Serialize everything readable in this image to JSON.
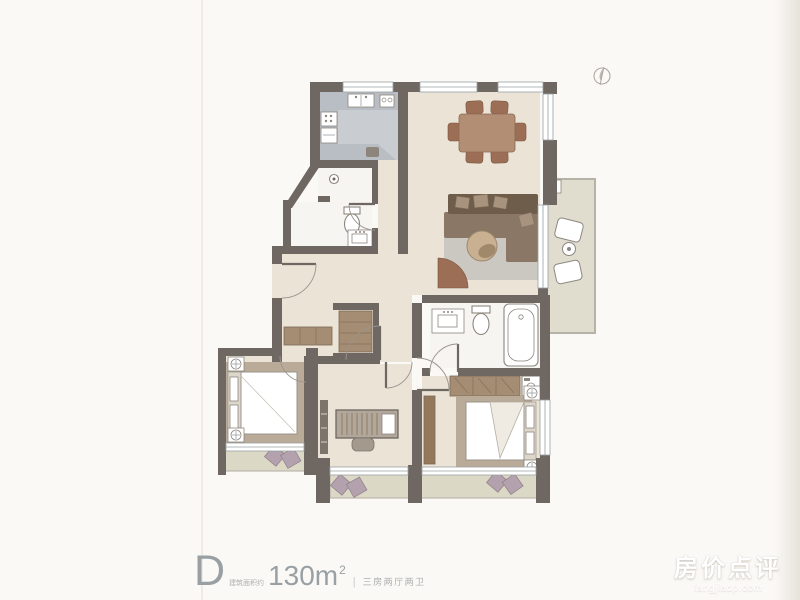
{
  "caption": {
    "unit_label": "D",
    "area_note": "建筑面积约",
    "area_value": "130m",
    "area_exponent": "2",
    "divider": "|",
    "layout_text": "三房两厅两卫"
  },
  "watermark": {
    "title": "房价点评",
    "domain": "fangjiadp.com"
  },
  "icons": {
    "compass": "north-compass-icon"
  },
  "colors": {
    "paper": "#fbf9f6",
    "wall": "#6f6862",
    "floor_main": "#eae3d6",
    "floor_kitchen": "#c9cdd1",
    "floor_bath": "#f6f5f2",
    "floor_balcony": "#e0ddcf",
    "floor_bay": "#dcd8c6",
    "bay_edge": "#b7b2a8",
    "counter": "#b8bec3",
    "line": "#8d867f",
    "window_line": "#9aa0a3",
    "door_line": "#9a948c",
    "rug_gray": "#cbc8c1",
    "rug_tan": "#b9ab97",
    "wood_dark": "#6f5d4b",
    "wood_mid": "#8a7765",
    "wood_table": "#b28e74",
    "wood_chair": "#9c6e55",
    "wardrobe": "#a58d74",
    "pillow": "#b3a2ad",
    "text_gray": "#98a0a3",
    "text_small": "#abb0b0",
    "watermark": "#ffffff"
  }
}
